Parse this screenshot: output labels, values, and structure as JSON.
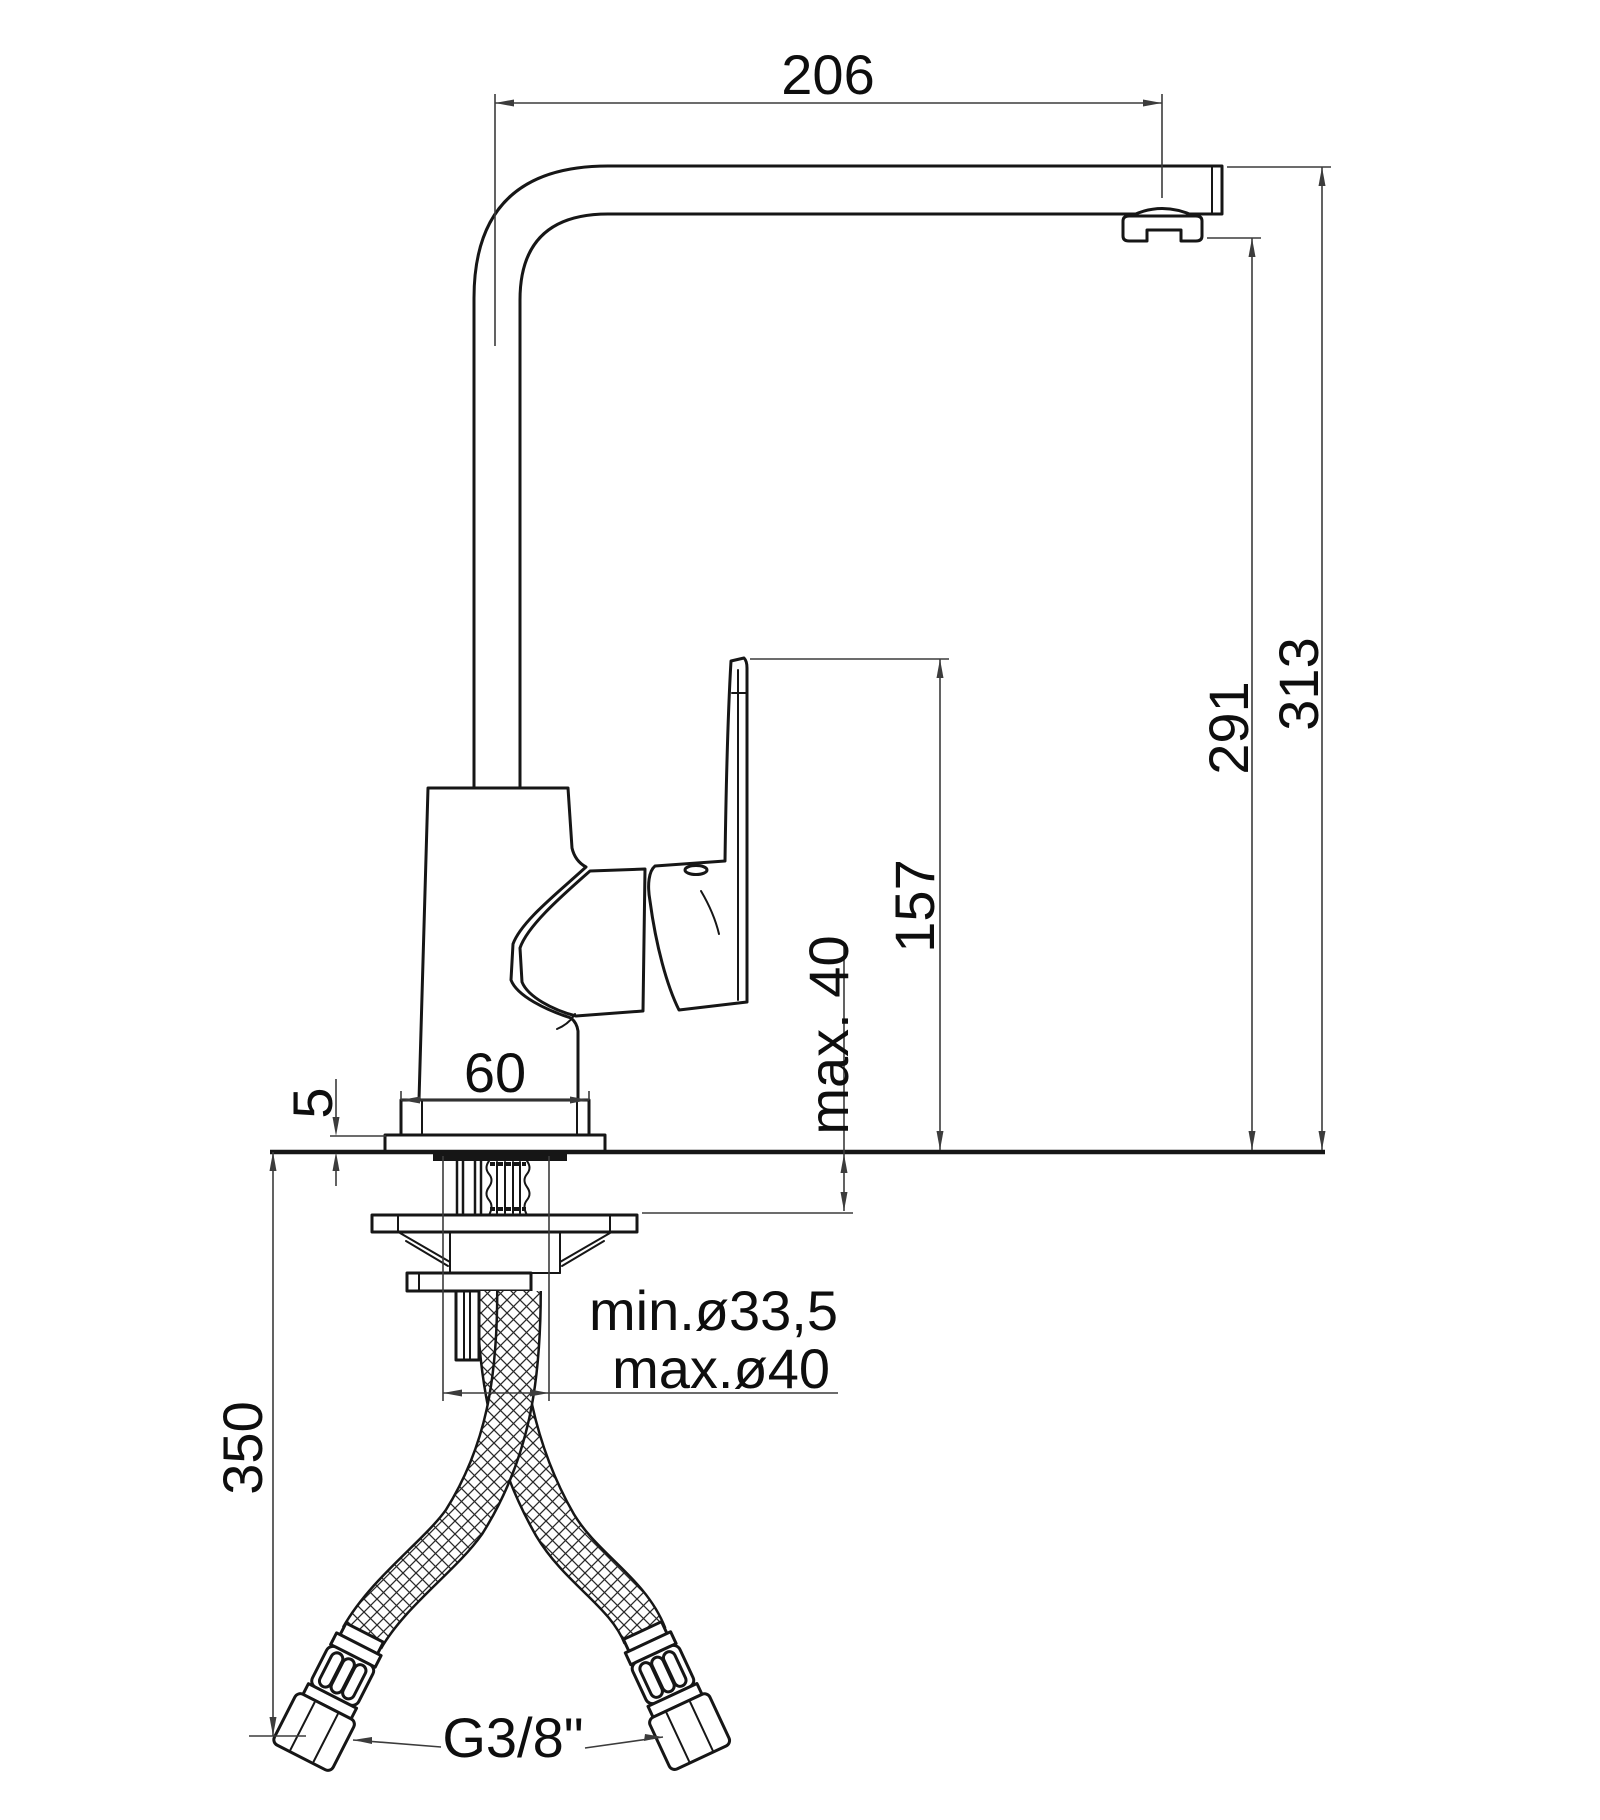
{
  "drawing": {
    "type": "faucet-installation-dimension-drawing",
    "dimensions": {
      "spout_reach": "206",
      "height_total": "313",
      "height_to_aerator": "291",
      "height_handle": "157",
      "counter_thickness_max": "max. 40",
      "base_width": "60",
      "base_plate_thickness": "5",
      "hole_diameter_min": "min.ø33,5",
      "hole_diameter_max": "max.ø40",
      "hose_drop_length": "350",
      "connection_thread": "G3/8\""
    },
    "colors": {
      "outline": "#161616",
      "dimension_lines": "#3c3c3c",
      "text": "#0e0e0e",
      "background": "#ffffff"
    }
  }
}
